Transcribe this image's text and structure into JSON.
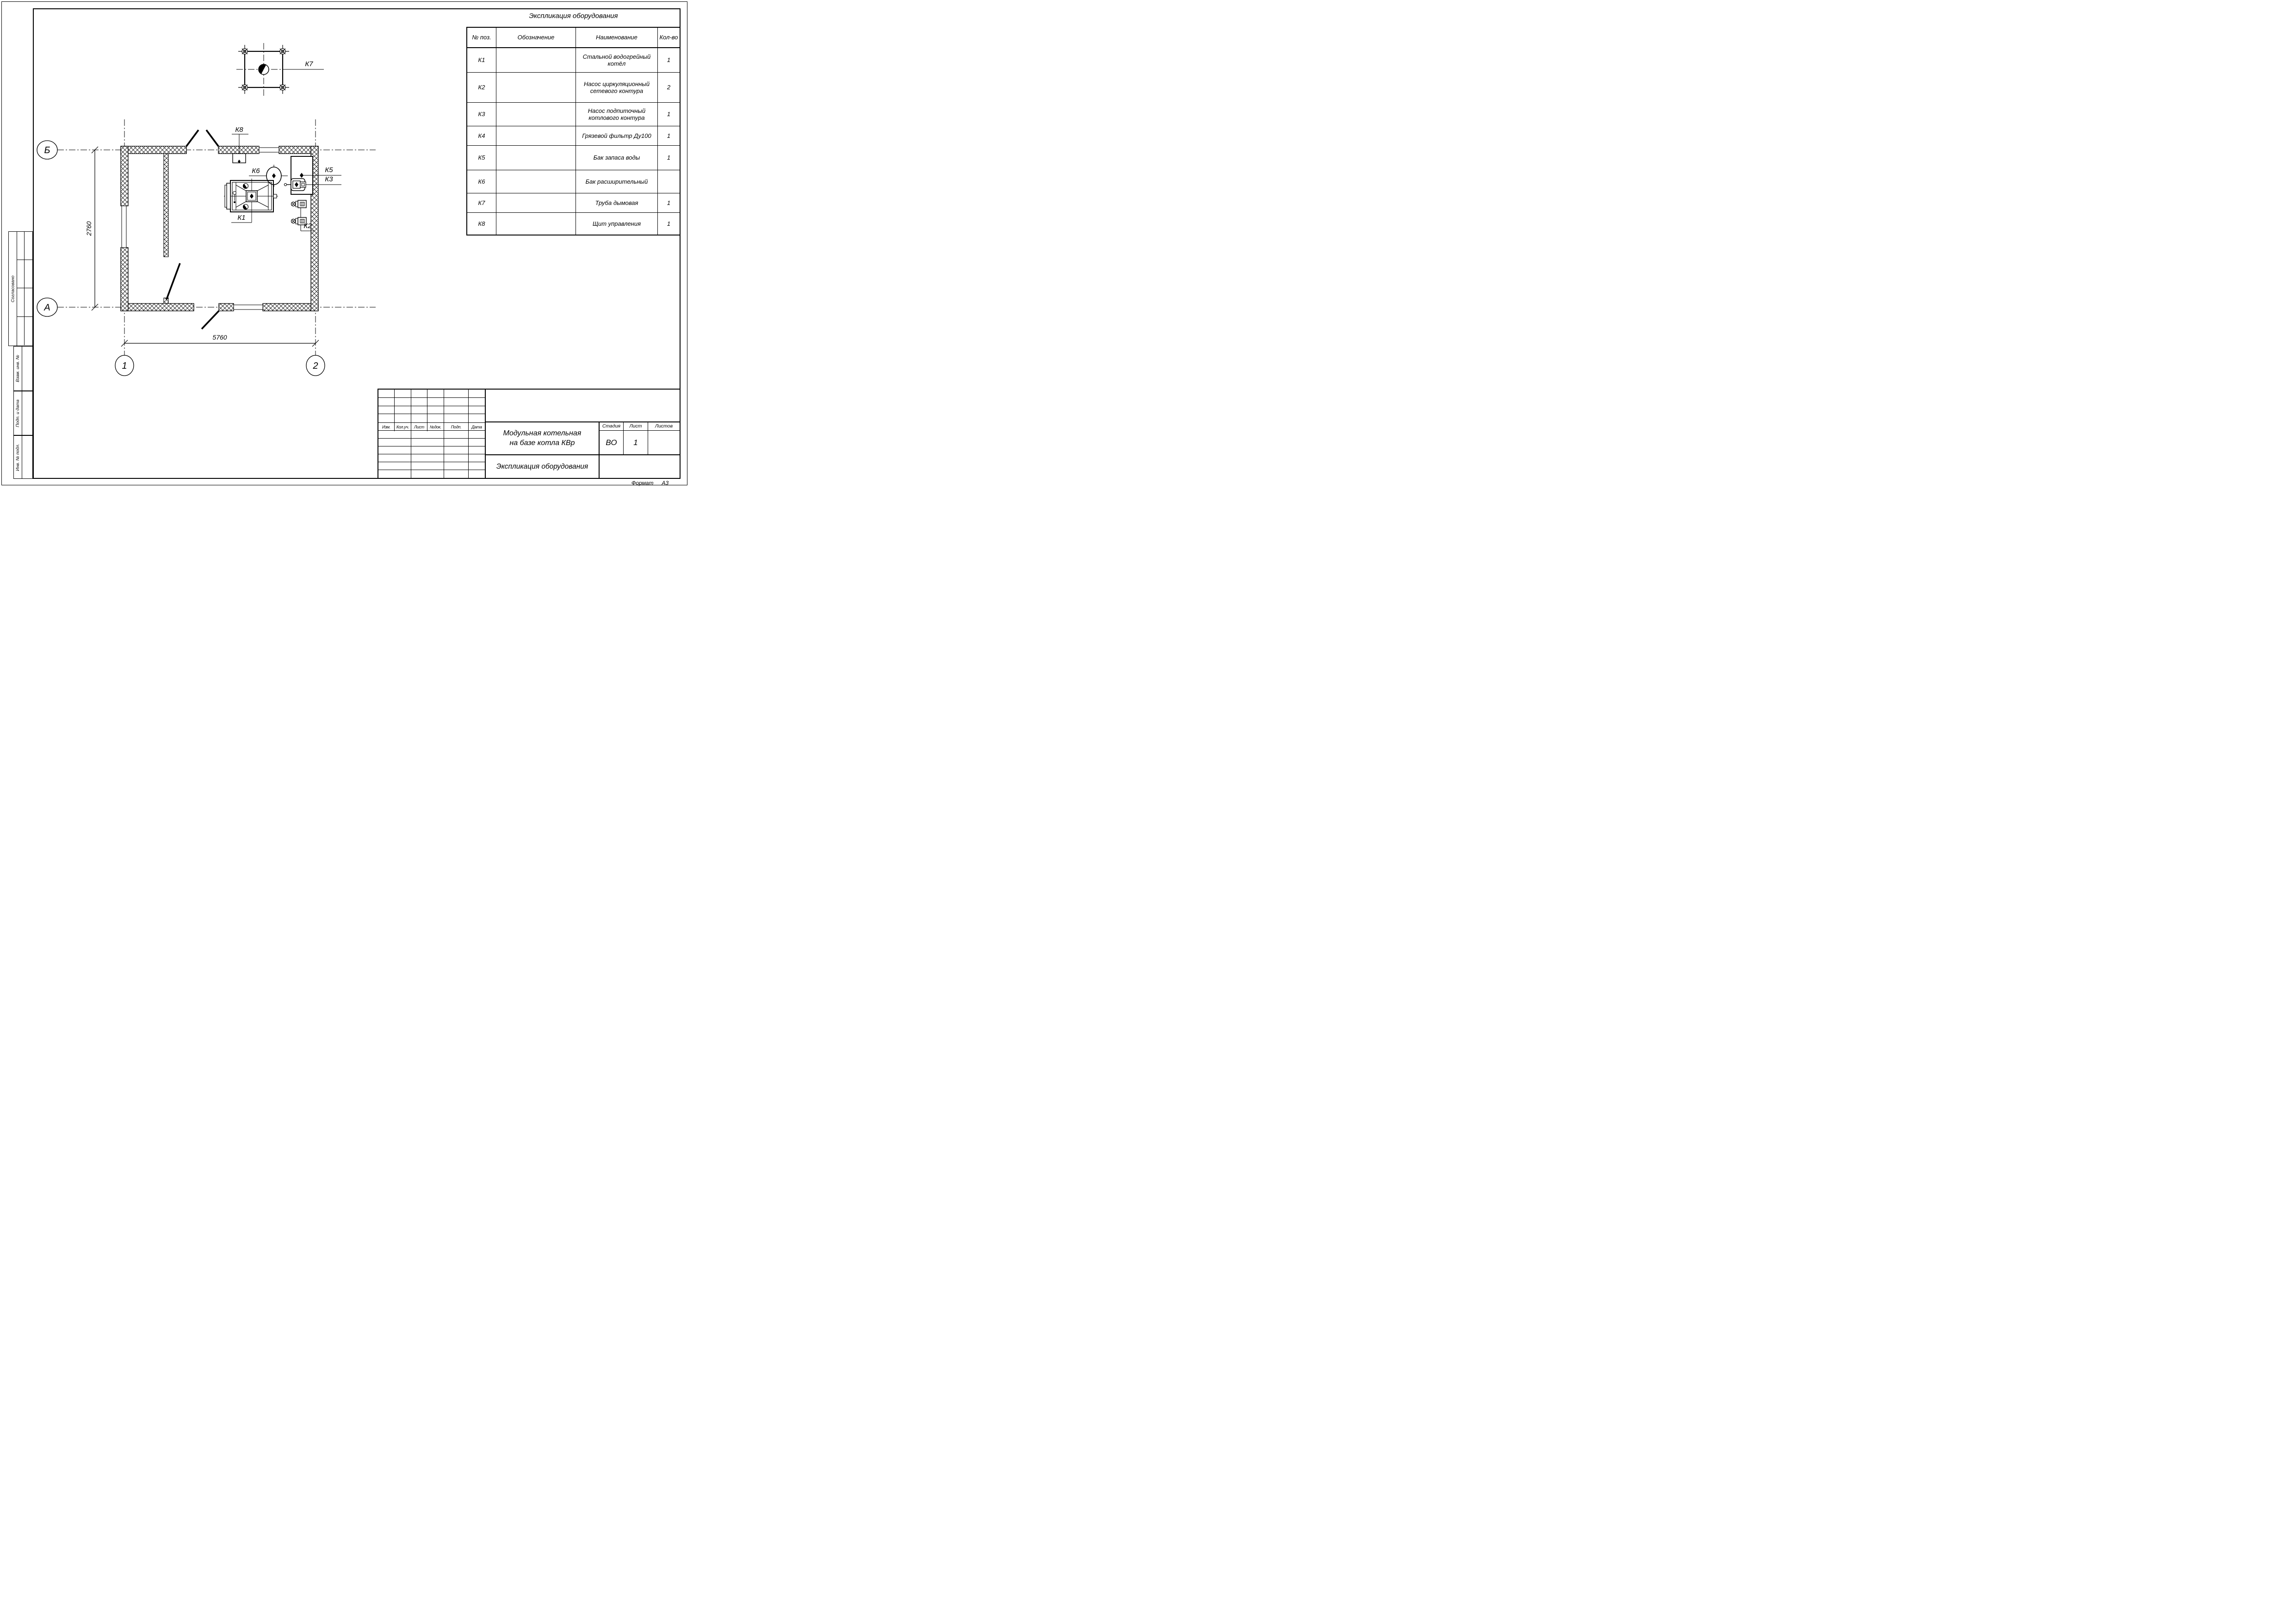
{
  "page": {
    "format_label": "Формат",
    "format_value": "А3"
  },
  "equipment_table": {
    "title": "Экспликация оборудования",
    "headers": {
      "pos": "№ поз.",
      "designation": "Обозначение",
      "name": "Наименование",
      "qty": "Кол-во"
    },
    "rows": [
      {
        "pos": "К1",
        "designation": "",
        "name": "Стальной водогрейный котёл",
        "qty": "1"
      },
      {
        "pos": "К2",
        "designation": "",
        "name": "Насос циркуляционный сетевого контура",
        "qty": "2"
      },
      {
        "pos": "К3",
        "designation": "",
        "name": "Насос подпиточный котлового контура",
        "qty": "1"
      },
      {
        "pos": "К4",
        "designation": "",
        "name": "Грязевой фильтр Ду100",
        "qty": "1"
      },
      {
        "pos": "К5",
        "designation": "",
        "name": "Бак запаса воды",
        "qty": "1"
      },
      {
        "pos": "К6",
        "designation": "",
        "name": "Бак расширительный",
        "qty": ""
      },
      {
        "pos": "К7",
        "designation": "",
        "name": "Труба дымовая",
        "qty": "1"
      },
      {
        "pos": "К8",
        "designation": "",
        "name": "Щит управления",
        "qty": "1"
      }
    ]
  },
  "plan": {
    "axis_letters": {
      "b": "Б",
      "a": "А",
      "n1": "1",
      "n2": "2"
    },
    "dimensions": {
      "width": "5760",
      "height": "2760"
    },
    "tags": {
      "k1": "К1",
      "k2": "К2",
      "k3": "К3",
      "k5": "К5",
      "k6": "К6",
      "k7": "К7",
      "k8": "К8"
    }
  },
  "title_block": {
    "project_line1": "Модульная котельная",
    "project_line2": "на базе котла КВр",
    "doc_name": "Экспликация оборудования",
    "stage_label": "Стадия",
    "stage_value": "ВО",
    "sheet_label": "Лист",
    "sheet_value": "1",
    "sheets_label": "Листов",
    "sheets_value": "",
    "rev_headers": [
      "Изм.",
      "Кол.уч.",
      "Лист",
      "№док.",
      "Подп.",
      "Дата"
    ]
  },
  "side_stamps": {
    "approved": "Согласовано",
    "vzam": "Взам. инв. №",
    "podp": "Подп. и дата",
    "inv": "Инв. № подл."
  }
}
